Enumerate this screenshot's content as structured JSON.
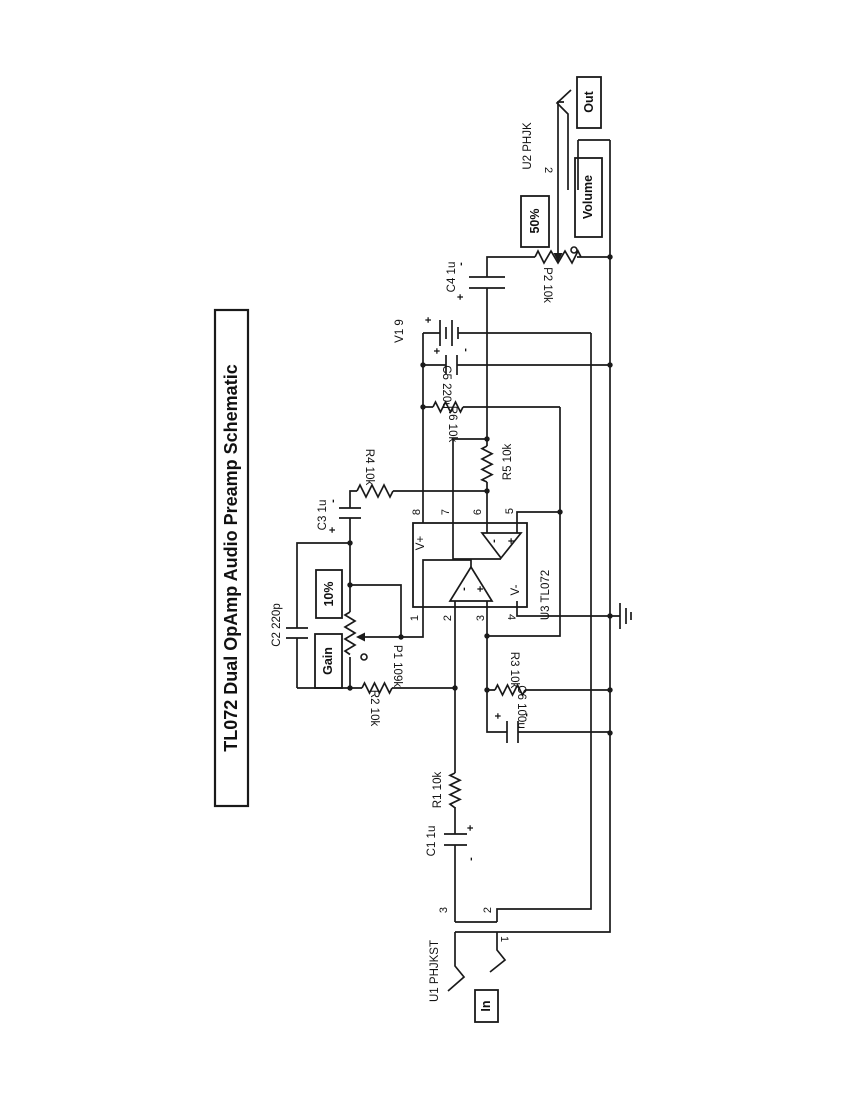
{
  "title": "TL072 Dual OpAmp Audio Preamp Schematic",
  "ic": {
    "ref": "U3 TL072",
    "v_plus": "V+",
    "v_minus": "V-",
    "pins_top": [
      "8",
      "7",
      "6",
      "5"
    ],
    "pins_bottom": [
      "1",
      "2",
      "3",
      "4"
    ],
    "opamp_minus": "-",
    "opamp_plus": "+"
  },
  "components": {
    "c1": "C1 1u",
    "c2": "C2 220p",
    "c3": "C3 1u",
    "c4": "C4 1u",
    "c5": "C5 220u",
    "c6": "C6 100u",
    "r1": "R1 10k",
    "r2": "R2 10k",
    "r3": "R3 10k",
    "r4": "R4 10k",
    "r5": "R5 10k",
    "r6": "R6 10k",
    "p1": "P1 109k",
    "p2": "P2 10k",
    "battery": "V1 9"
  },
  "polarity": {
    "plus": "+",
    "minus": "-"
  },
  "jacks": {
    "input": {
      "ref": "U1 PHJKST",
      "pin_tip": "3",
      "pin_sleeve": "2",
      "pin_ring": "1"
    },
    "output": {
      "ref": "U2 PHJK",
      "pin_tip": "2"
    }
  },
  "badges": {
    "in": "In",
    "out": "Out",
    "gain": "Gain",
    "gain_value": "10%",
    "volume": "Volume",
    "volume_value": "50%"
  }
}
